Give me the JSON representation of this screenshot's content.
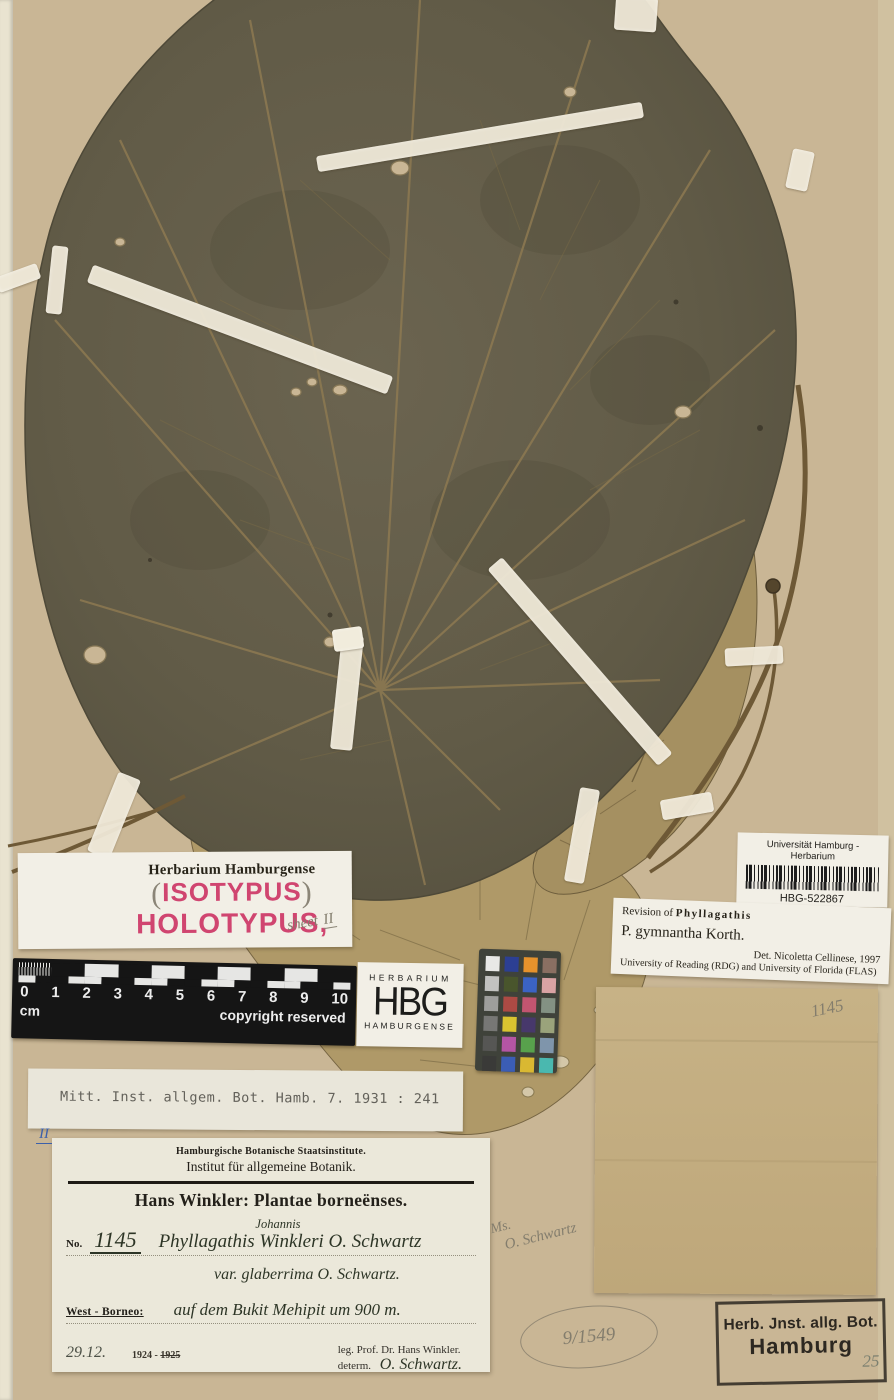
{
  "colors": {
    "paper": "#c9b695",
    "paper_edge": "#e9e3d0",
    "leaf_dark": "#635c49",
    "leaf_vein": "#8d7951",
    "leaf_skeletal": "#a59061",
    "tape": "#eee8d7",
    "stamp_pink": "#d04570",
    "ink": "#2d3526",
    "pencil": "#837d6d",
    "blue_ink": "#3c60aa"
  },
  "labels": {
    "barcode": {
      "title": "Universität Hamburg - Herbarium",
      "code": "HBG-522867"
    },
    "revision": {
      "prefix": "Revision of ",
      "genus": "Phyllagathis",
      "species": "P. gymnantha Korth.",
      "det": "Det.  Nicoletta Cellinese, 1997",
      "institutions": "University of Reading (RDG) and University of Florida (FLAS)"
    },
    "type_label": {
      "title": "Herbarium Hamburgense",
      "isotypus": "ISOTYPUS",
      "holotypus": "HOLOTYPUS,",
      "paren_open": "(",
      "paren_close": ")",
      "sheet_word": "sheet",
      "sheet_num": "II"
    },
    "publication": "Mitt. Inst. allgem. Bot. Hamb. 7. 1931 : 241",
    "main": {
      "institute1": "Hamburgische Botanische Staatsinstitute.",
      "institute2": "Institut für allgemeine Botanik.",
      "series": "Hans Winkler: Plantae borneënses.",
      "no_label": "No.",
      "no_value": "1145",
      "name_part1": "Phyllagathis",
      "name_inserted": "Johannis",
      "name_part2": "Winkleri",
      "name_part3": "O. Schwartz",
      "variety": "var. glaberrima O. Schwartz.",
      "locality_label": "West - Borneo:",
      "locality": "auf dem Bukit Mehipit um 900 m.",
      "date_hand": "29.12.",
      "date_printed": "1924 -",
      "date_struck": "1925",
      "collector": "leg. Prof. Dr. Hans Winkler.",
      "determ_label": "determ.",
      "determ_value": "O. Schwartz."
    },
    "stamp": {
      "line1": "Herb. Jnst. allg. Bot.",
      "line2": "Hamburg",
      "pencil_number": "25"
    },
    "pencil_notes": {
      "sheet_roman": "II",
      "envelope_number": "1145",
      "accession": "9/1549",
      "schwartz_line1": "Ms.",
      "schwartz_line2": "O. Schwartz"
    }
  },
  "ruler": {
    "ticks": [
      "0",
      "1",
      "2",
      "3",
      "4",
      "5",
      "6",
      "7",
      "8",
      "9",
      "10"
    ],
    "unit": "cm",
    "copyright": "copyright reserved"
  },
  "hbg_logo": {
    "top": "HERBARIUM",
    "acronym": "HBG",
    "bottom": "HAMBURGENSE"
  },
  "color_chart": {
    "palette": [
      [
        "#e8e8e6",
        "#2c3f93",
        "#e6922c",
        "#8a6f62"
      ],
      [
        "#c2c2c0",
        "#49552c",
        "#3b63c4",
        "#d9a3a4"
      ],
      [
        "#9e9e9c",
        "#ad4a44",
        "#c25570",
        "#839183"
      ],
      [
        "#777775",
        "#d9c430",
        "#47386b",
        "#9aa37b"
      ],
      [
        "#565654",
        "#b455a4",
        "#58a14c",
        "#7f95ab"
      ],
      [
        "#3a3a38",
        "#3b5db5",
        "#d9b832",
        "#4ab8af"
      ]
    ]
  }
}
